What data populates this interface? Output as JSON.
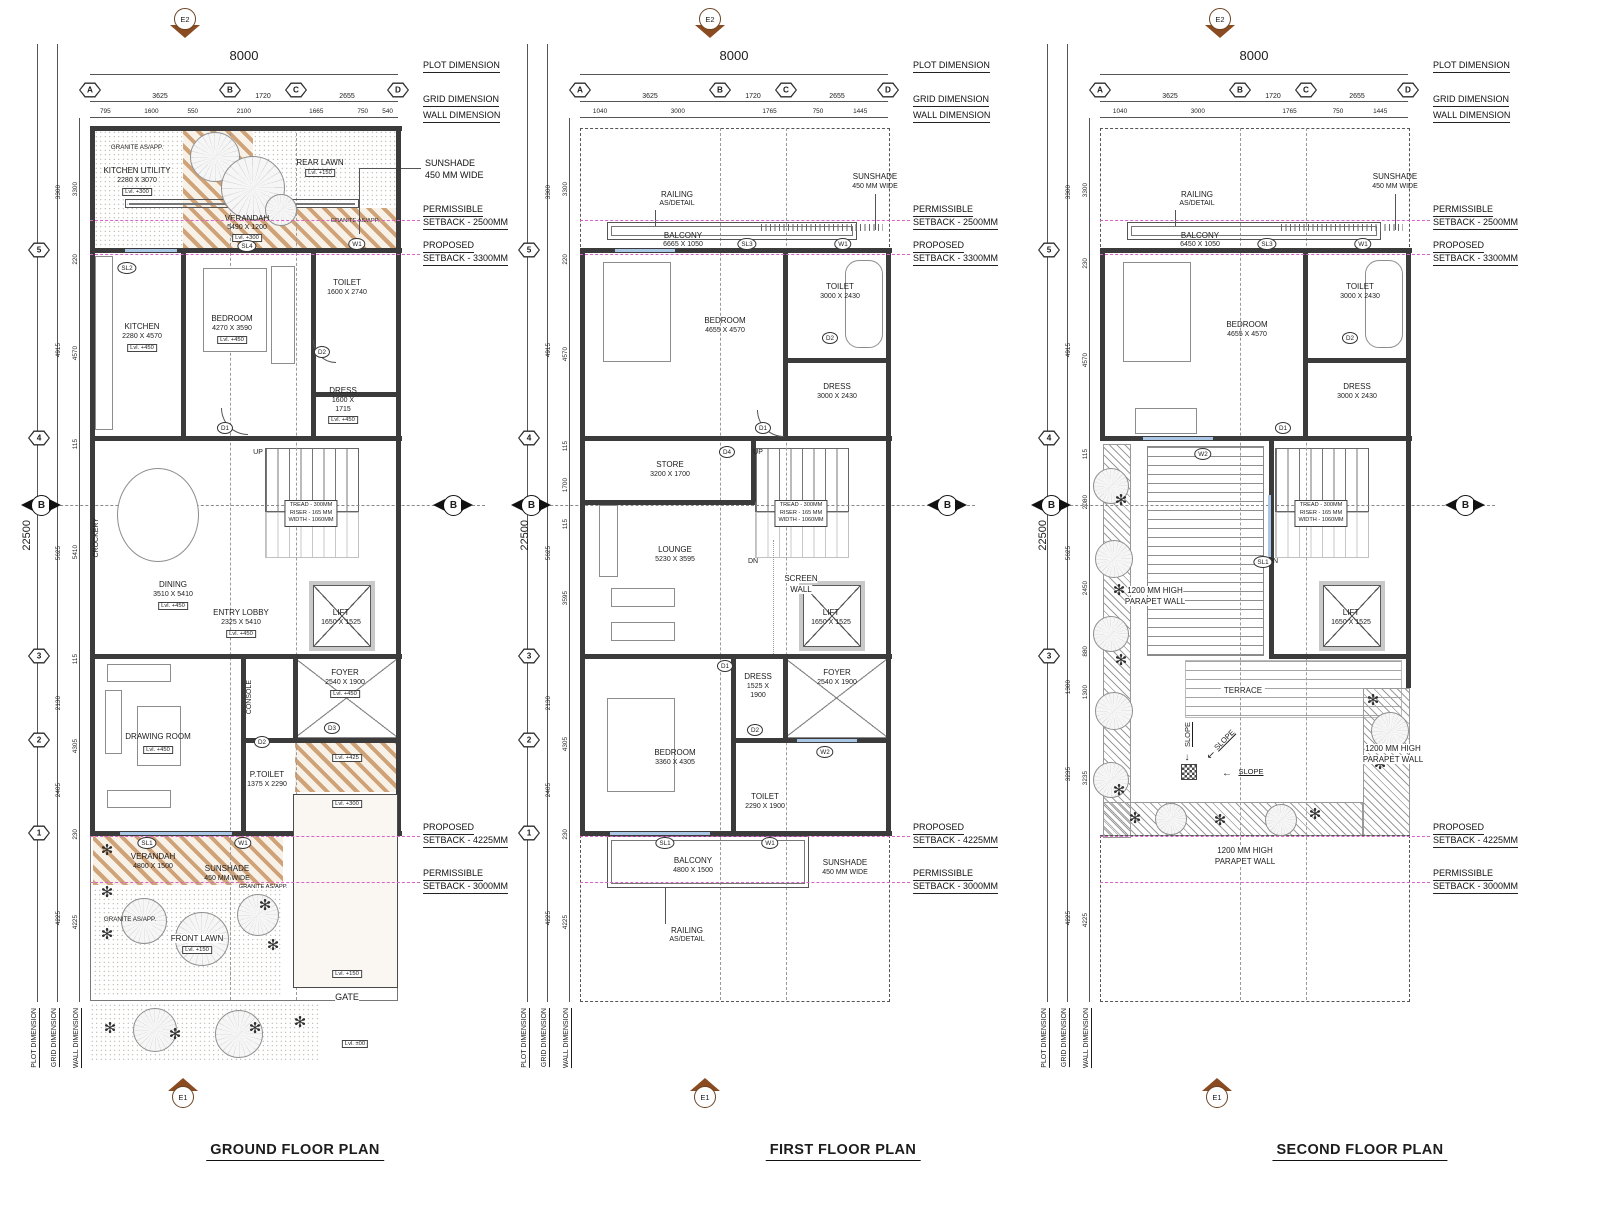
{
  "colors": {
    "hatch_tan": "#cfa277",
    "setback_magenta": "#d863c8",
    "wall_dark": "#3b3b3b",
    "window_blue": "#a9c7e5",
    "north_brown": "#8a4b21"
  },
  "shared": {
    "plot_w": "8000",
    "plot_h": "22500",
    "dims": {
      "plot": "PLOT DIMENSION",
      "grid": "GRID DIMENSION",
      "wall": "WALL DIMENSION"
    },
    "grid_letters": [
      "A",
      "B",
      "C",
      "D"
    ],
    "grid_dims": [
      "3625",
      "1720",
      "2655"
    ],
    "row_markers": [
      "5",
      "4",
      "3",
      "2",
      "1"
    ],
    "section": "B",
    "e2": "E2",
    "e1": "E1",
    "up": "UP",
    "dn": "DN",
    "gate": "GATE",
    "granite": "GRANITE AS/APP.",
    "sunshade": [
      "SUNSHADE",
      "450 MM WIDE"
    ],
    "railing": [
      "RAILING",
      "AS/DETAIL"
    ],
    "screen_wall": [
      "SCREEN",
      "WALL"
    ],
    "stair_note": [
      "TREAD - 300MM",
      "RISER - 165 MM",
      "WIDTH - 1060MM"
    ],
    "lift": [
      "LIFT",
      "1650 X 1525"
    ],
    "parapet": [
      "1200 MM HIGH",
      "PARAPET WALL"
    ],
    "slope": "SLOPE",
    "crockery": "CROCKERY",
    "console": "CONSOLE",
    "setbacks": {
      "perm2500": [
        "PERMISSIBLE",
        "SETBACK - 2500MM"
      ],
      "prop3300": [
        "PROPOSED",
        "SETBACK - 3300MM"
      ],
      "prop4225": [
        "PROPOSED",
        "SETBACK - 4225MM"
      ],
      "perm3000": [
        "PERMISSIBLE",
        "SETBACK - 3000MM"
      ]
    },
    "levels": {
      "l000": "Lvl. ±00",
      "l150": "Lvl. +150",
      "l300": "Lvl. +300",
      "l425": "Lvl. +425",
      "l450": "Lvl. +450"
    }
  },
  "gf": {
    "title": "GROUND FLOOR PLAN",
    "wall_dims": [
      "795",
      "1600",
      "550",
      "2100",
      "1665",
      "750",
      "540"
    ],
    "left_grid": [
      "3300",
      "4915",
      "5625",
      "2130",
      "2405",
      "4225"
    ],
    "left_wall": [
      "3300",
      "220",
      "4570",
      "115",
      "5410",
      "115",
      "4305",
      "230",
      "4225"
    ],
    "r": {
      "ku": [
        "KITCHEN UTILITY",
        "2280 X 3070"
      ],
      "rearlawn": "REAR LAWN",
      "ver": [
        "VERANDAH",
        "5490 X 1200"
      ],
      "kitchen": [
        "KITCHEN",
        "2280 X 4570"
      ],
      "bed": [
        "BEDROOM",
        "4270 X 3590"
      ],
      "toilet": [
        "TOILET",
        "1600 X 2740"
      ],
      "dress": [
        "DRESS",
        "1600 X",
        "1715"
      ],
      "dining": [
        "DINING",
        "3510 X 5410"
      ],
      "entry": [
        "ENTRY LOBBY",
        "2325 X 5410"
      ],
      "draw": "DRAWING ROOM",
      "ptoilet": [
        "P.TOILET",
        "1375 X 2290"
      ],
      "foyer": [
        "FOYER",
        "2540 X 1900"
      ],
      "ver2": [
        "VERANDAH",
        "4800 X 1500"
      ],
      "frontlawn": "FRONT LAWN"
    },
    "tags": {
      "sl2": "SL2",
      "sl4": "SL4",
      "w1": "W1",
      "d1": "D1",
      "d2": "D2",
      "d3": "D3",
      "sl1": "SL1"
    }
  },
  "ff": {
    "title": "FIRST FLOOR PLAN",
    "wall_dims": [
      "1040",
      "3000",
      "1765",
      "750",
      "1445"
    ],
    "left_grid": [
      "3300",
      "4915",
      "5625",
      "2130",
      "2405",
      "4225"
    ],
    "left_wall": [
      "3300",
      "220",
      "4570",
      "115",
      "1700",
      "115",
      "3595",
      "4305",
      "230",
      "4225"
    ],
    "r": {
      "balcony": [
        "BALCONY",
        "6665 X 1050"
      ],
      "bed": [
        "BEDROOM",
        "4655 X 4570"
      ],
      "toilet": [
        "TOILET",
        "3000 X 2430"
      ],
      "dress": [
        "DRESS",
        "3000 X 2430"
      ],
      "store": [
        "STORE",
        "3200 X 1700"
      ],
      "lounge": [
        "LOUNGE",
        "5230 X 3595"
      ],
      "dress2": [
        "DRESS",
        "1525 X",
        "1900"
      ],
      "foyer": [
        "FOYER",
        "2540 X 1900"
      ],
      "bed2": [
        "BEDROOM",
        "3360 X 4305"
      ],
      "toilet2": [
        "TOILET",
        "2290 X 1900"
      ],
      "balcony2": [
        "BALCONY",
        "4800 X 1500"
      ]
    },
    "tags": {
      "sl3": "SL3",
      "w1": "W1",
      "d1": "D1",
      "d2": "D2",
      "d4": "D4",
      "w2": "W2",
      "sl1": "SL1"
    }
  },
  "sf": {
    "title": "SECOND FLOOR PLAN",
    "wall_dims": [
      "1040",
      "3000",
      "1765",
      "750",
      "1445"
    ],
    "left_grid": [
      "3300",
      "4915",
      "5625",
      "1300",
      "3235",
      "4225"
    ],
    "left_wall": [
      "3300",
      "230",
      "4570",
      "115",
      "2080",
      "2450",
      "880",
      "1300",
      "3235",
      "4225"
    ],
    "r": {
      "balcony": [
        "BALCONY",
        "6450 X 1050"
      ],
      "bed": [
        "BEDROOM",
        "4655 X 4570"
      ],
      "toilet": [
        "TOILET",
        "3000 X 2430"
      ],
      "dress": [
        "DRESS",
        "3000 X 2430"
      ],
      "terrace": "TERRACE"
    },
    "tags": {
      "sl3": "SL3",
      "w1": "W1",
      "d1": "D1",
      "d2": "D2",
      "w2": "W2",
      "sl1": "SL1"
    }
  }
}
